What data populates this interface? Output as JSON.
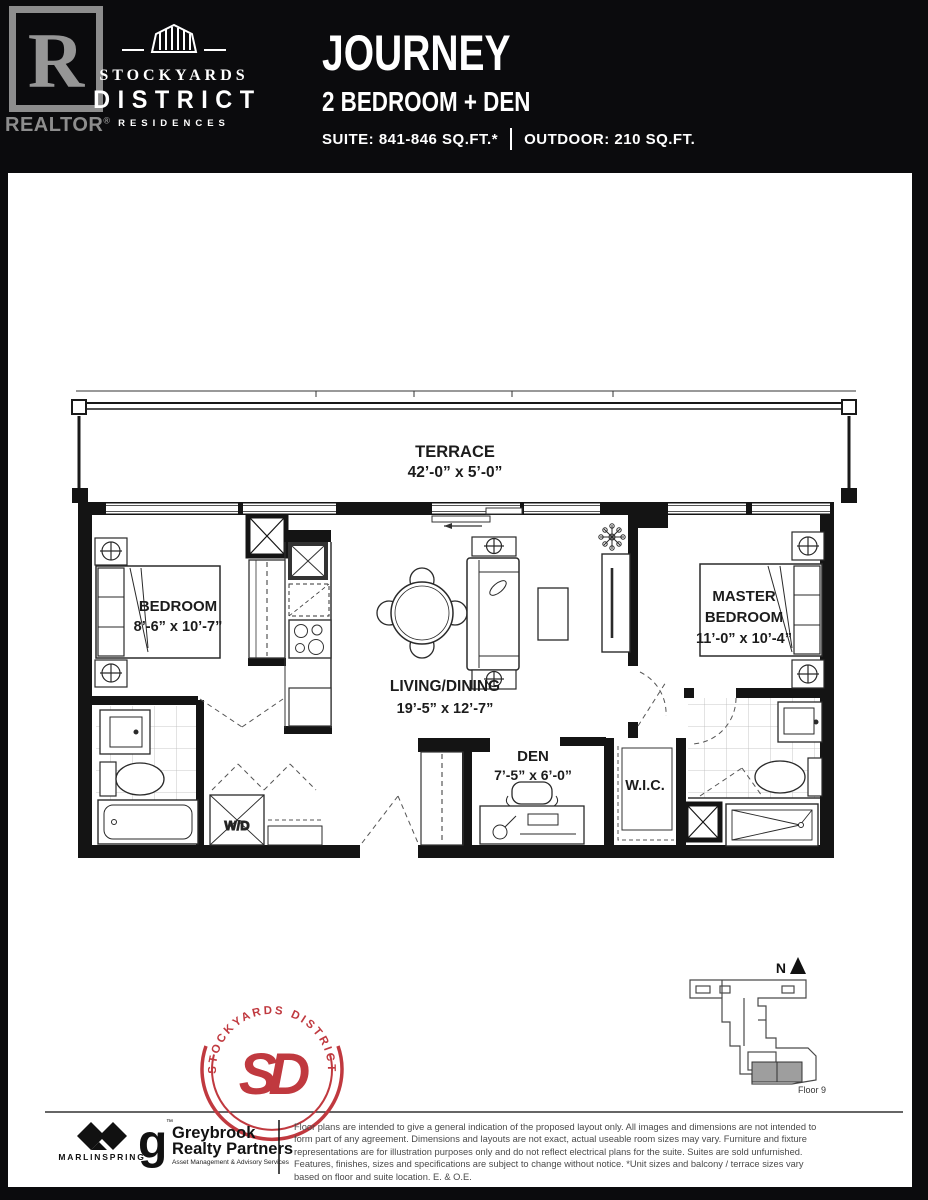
{
  "header": {
    "realtor": {
      "letter": "R",
      "label": "REALTOR",
      "reg": "®"
    },
    "brand": {
      "top": "STOCKYARDS",
      "mid": "DISTRICT",
      "bottom": "RESIDENCES"
    },
    "plan_name": "JOURNEY",
    "plan_type": "2 BEDROOM + DEN",
    "suite_area": "SUITE: 841-846 SQ.FT.*",
    "outdoor_area": "OUTDOOR: 210 SQ.FT."
  },
  "floorplan": {
    "terrace": {
      "name": "TERRACE",
      "dims": "42’-0” x 5’-0”"
    },
    "bedroom": {
      "name": "BEDROOM",
      "dims": "8’-6” x 10’-7”"
    },
    "living": {
      "name": "LIVING/DINING",
      "dims": "19’-5” x 12’-7”"
    },
    "master": {
      "name1": "MASTER",
      "name2": "BEDROOM",
      "dims": "11’-0” x 10’-4”"
    },
    "den": {
      "name": "DEN",
      "dims": "7’-5” x 6’-0”"
    },
    "wic": {
      "name": "W.I.C."
    },
    "wd": {
      "name": "W/D"
    }
  },
  "keyplate": {
    "north": "N",
    "floor": "Floor 9"
  },
  "seal": {
    "arc_text": "STOCKYARDS  DISTRICT",
    "monogram": "SD"
  },
  "footer": {
    "marlin": "MARLINSPRING",
    "greybrook_g": "g",
    "greybrook_tm": "™",
    "greybrook_line1": "Greybrook",
    "greybrook_line2": "Realty Partners",
    "greybrook_tag": "Asset Management & Advisory Services",
    "disclaimer": [
      "Floor plans are intended to give a general indication of the proposed layout only. All images and dimensions are not intended to",
      "form part of any agreement. Dimensions and layouts are not exact, actual useable room sizes may vary. Furniture and fixture",
      "representations are for illustration purposes only and do not reflect electrical plans for the suite. Suites are sold unfurnished.",
      "Features, finishes, sizes and specifications are subject to change without notice. *Unit sizes and balcony / terrace sizes vary",
      "based on floor and suite location. E. & O.E."
    ]
  },
  "colors": {
    "accent_red": "#c0393f",
    "wall_black": "#141414"
  }
}
